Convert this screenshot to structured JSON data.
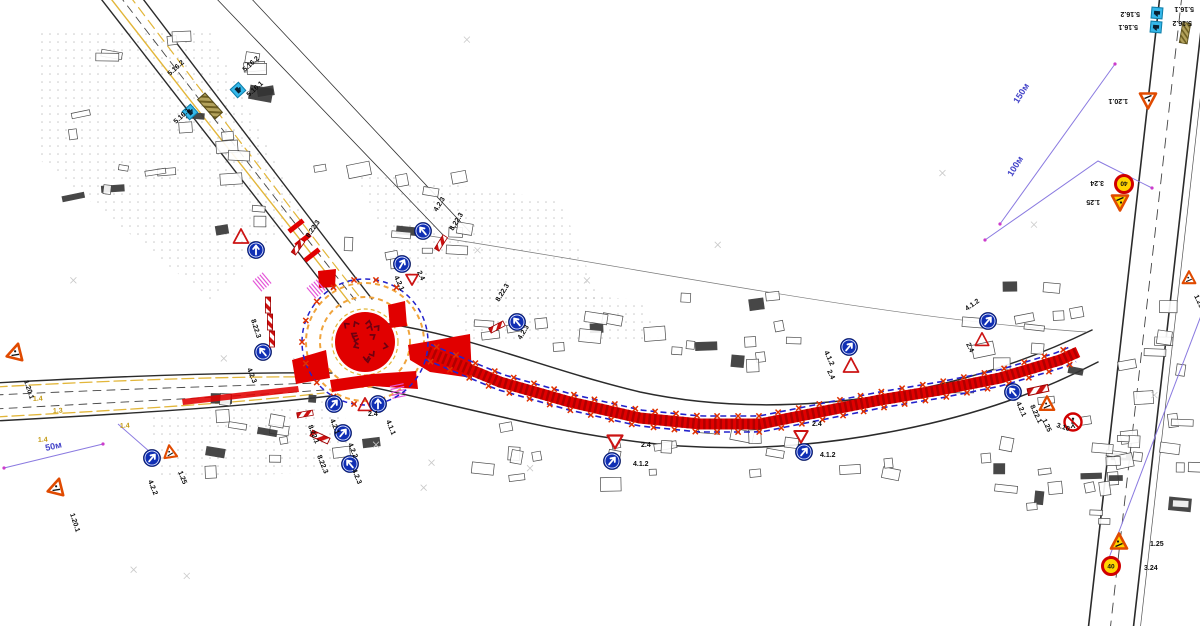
{
  "drawing": {
    "kind": "temporary-traffic-management-plan",
    "palette": {
      "work_zone_red": "#e10000",
      "work_zone_hatch": "#b00000",
      "barrier_blue": "#2323cc",
      "sign_blue": "#102fb4",
      "bus_cyan": "#35b8ea",
      "temp_yellow": "#ffd400",
      "warn_border": "#e04a00",
      "give_way_red": "#cc1414",
      "dim_purple": "#8a7ae0",
      "dim_text_blue": "#4343c8",
      "magenta": "#e457d8",
      "road_marking_yellow": "#e2b63a",
      "shelter_olive": "#8a7a30"
    },
    "signs": [
      {
        "type": "warn",
        "x": 16,
        "y": 352,
        "rot": 14
      },
      {
        "type": "warn",
        "x": 57,
        "y": 487,
        "rot": 14
      },
      {
        "type": "blue-circle",
        "x": 152,
        "y": 458,
        "arot": 40
      },
      {
        "type": "warn",
        "x": 170,
        "y": 452,
        "rot": -8,
        "scale": 0.8
      },
      {
        "type": "bus",
        "x": 190,
        "y": 112,
        "rot": 48
      },
      {
        "type": "bus",
        "x": 238,
        "y": 90,
        "rot": 48
      },
      {
        "type": "shelter",
        "x": 210,
        "y": 106,
        "rot": 48
      },
      {
        "type": "warn-line",
        "x": 241,
        "y": 237
      },
      {
        "type": "blue-circle",
        "x": 256,
        "y": 250,
        "arot": 0
      },
      {
        "type": "beacon",
        "x": 298,
        "y": 247,
        "rot": -55
      },
      {
        "type": "blue-circle",
        "x": 263,
        "y": 352,
        "arot": -40
      },
      {
        "type": "beacon",
        "x": 268,
        "y": 305,
        "rot": 90
      },
      {
        "type": "beacon",
        "x": 270,
        "y": 322,
        "rot": 90
      },
      {
        "type": "beacon",
        "x": 272,
        "y": 339,
        "rot": 90
      },
      {
        "type": "blue-circle",
        "x": 402,
        "y": 264,
        "arot": 30
      },
      {
        "type": "give-way",
        "x": 412,
        "y": 279,
        "scale": 0.8
      },
      {
        "type": "blue-circle",
        "x": 423,
        "y": 231,
        "arot": -40
      },
      {
        "type": "beacon",
        "x": 441,
        "y": 243,
        "rot": -58
      },
      {
        "type": "blue-circle",
        "x": 517,
        "y": 322,
        "arot": -40
      },
      {
        "type": "beacon",
        "x": 497,
        "y": 327,
        "rot": -28
      },
      {
        "type": "give-way",
        "x": 615,
        "y": 441
      },
      {
        "type": "blue-circle",
        "x": 612,
        "y": 461,
        "arot": 40
      },
      {
        "type": "give-way",
        "x": 801,
        "y": 436,
        "scale": 0.9
      },
      {
        "type": "blue-circle",
        "x": 804,
        "y": 452,
        "arot": 40
      },
      {
        "type": "blue-circle",
        "x": 849,
        "y": 347,
        "arot": 40
      },
      {
        "type": "warn-line",
        "x": 851,
        "y": 366
      },
      {
        "type": "blue-circle",
        "x": 988,
        "y": 321,
        "arot": 40
      },
      {
        "type": "warn-line",
        "x": 982,
        "y": 340,
        "scale": 0.9
      },
      {
        "type": "blue-circle",
        "x": 1013,
        "y": 392,
        "arot": -40
      },
      {
        "type": "beacon",
        "x": 1038,
        "y": 390,
        "rot": -12,
        "scale": 1.3
      },
      {
        "type": "warn",
        "x": 1047,
        "y": 404,
        "scale": 0.9
      },
      {
        "type": "no-ped",
        "x": 1073,
        "y": 422
      },
      {
        "type": "warn-temp",
        "x": 1119,
        "y": 542
      },
      {
        "type": "speed40",
        "x": 1111,
        "y": 566
      },
      {
        "type": "warn-temp",
        "x": 1120,
        "y": 202,
        "rot": 180
      },
      {
        "type": "speed40",
        "x": 1124,
        "y": 184,
        "rot": 180
      },
      {
        "type": "warn",
        "x": 1148,
        "y": 100,
        "rot": 180
      },
      {
        "type": "bus",
        "x": 1157,
        "y": 13,
        "rot": 185
      },
      {
        "type": "bus",
        "x": 1156,
        "y": 27,
        "rot": 185
      },
      {
        "type": "shelter",
        "x": 1185,
        "y": 33,
        "rot": 100,
        "scale": 0.8
      },
      {
        "type": "warn",
        "x": 1189,
        "y": 278,
        "scale": 0.8
      },
      {
        "type": "beacon",
        "x": 305,
        "y": 414,
        "rot": -10
      },
      {
        "type": "beacon",
        "x": 320,
        "y": 437,
        "rot": 25,
        "scale": 1.2
      },
      {
        "type": "blue-circle",
        "x": 334,
        "y": 404,
        "arot": 40
      },
      {
        "type": "warn-line",
        "x": 365,
        "y": 405,
        "scale": 0.9
      },
      {
        "type": "blue-circle",
        "x": 378,
        "y": 404,
        "arot": 0
      },
      {
        "type": "blue-circle",
        "x": 343,
        "y": 433,
        "arot": 40
      },
      {
        "type": "blue-circle",
        "x": 350,
        "y": 464,
        "arot": -40
      }
    ],
    "sign_code_labels": [
      {
        "t": "1.20.1",
        "x": 24,
        "y": 381,
        "r": 72
      },
      {
        "t": "1.20.1",
        "x": 70,
        "y": 514,
        "r": 72
      },
      {
        "t": "4.2.2",
        "x": 148,
        "y": 481,
        "r": 68
      },
      {
        "t": "1.25",
        "x": 178,
        "y": 472,
        "r": 68
      },
      {
        "t": "5.16.2",
        "x": 170,
        "y": 76,
        "r": -42
      },
      {
        "t": "5.16.1",
        "x": 176,
        "y": 124,
        "r": -42
      },
      {
        "t": "5.16.2",
        "x": 245,
        "y": 72,
        "r": -42
      },
      {
        "t": "5.16.1",
        "x": 249,
        "y": 97,
        "r": -42
      },
      {
        "t": "8.22.3",
        "x": 251,
        "y": 320,
        "r": 72
      },
      {
        "t": "4.2.3",
        "x": 247,
        "y": 369,
        "r": 68
      },
      {
        "t": "8.22.3",
        "x": 309,
        "y": 238,
        "r": -55
      },
      {
        "t": "4.2.3",
        "x": 437,
        "y": 212,
        "r": -58
      },
      {
        "t": "8.22.3",
        "x": 453,
        "y": 231,
        "r": -58
      },
      {
        "t": "4.2.1",
        "x": 394,
        "y": 277,
        "r": 65
      },
      {
        "t": "2.4",
        "x": 417,
        "y": 272,
        "r": 65
      },
      {
        "t": "8.22.3",
        "x": 499,
        "y": 302,
        "r": -58
      },
      {
        "t": "4.2.3",
        "x": 521,
        "y": 340,
        "r": -58
      },
      {
        "t": "2.4",
        "x": 641,
        "y": 447,
        "r": 0
      },
      {
        "t": "4.1.2",
        "x": 633,
        "y": 466,
        "r": 0
      },
      {
        "t": "2.4",
        "x": 812,
        "y": 426,
        "r": 0
      },
      {
        "t": "4.1.2",
        "x": 820,
        "y": 457,
        "r": 0
      },
      {
        "t": "4.1.2",
        "x": 824,
        "y": 352,
        "r": 65
      },
      {
        "t": "2.4",
        "x": 827,
        "y": 371,
        "r": 65
      },
      {
        "t": "4.1.2",
        "x": 967,
        "y": 311,
        "r": -35
      },
      {
        "t": "2.4",
        "x": 966,
        "y": 344,
        "r": 65
      },
      {
        "t": "4.2.1",
        "x": 1016,
        "y": 403,
        "r": 65
      },
      {
        "t": "8.22.1",
        "x": 1030,
        "y": 406,
        "r": 65
      },
      {
        "t": "1.25",
        "x": 1042,
        "y": 420,
        "r": 65
      },
      {
        "t": "3.10",
        "x": 1056,
        "y": 427,
        "r": 18
      },
      {
        "t": "1.25",
        "x": 1150,
        "y": 546,
        "r": 0
      },
      {
        "t": "3.24",
        "x": 1144,
        "y": 570,
        "r": 0
      },
      {
        "t": "3.24",
        "x": 1104,
        "y": 181,
        "r": 180
      },
      {
        "t": "1.25",
        "x": 1100,
        "y": 200,
        "r": 180
      },
      {
        "t": "1.20.1",
        "x": 1128,
        "y": 99,
        "r": 180
      },
      {
        "t": "5.16.2",
        "x": 1140,
        "y": 12,
        "r": 180
      },
      {
        "t": "5.16.1",
        "x": 1138,
        "y": 25,
        "r": 180
      },
      {
        "t": "5.16.1",
        "x": 1194,
        "y": 7,
        "r": 180
      },
      {
        "t": "5.16.2",
        "x": 1192,
        "y": 21,
        "r": 180
      },
      {
        "t": "1.25",
        "x": 1194,
        "y": 296,
        "r": 65
      },
      {
        "t": "8.22.1",
        "x": 308,
        "y": 426,
        "r": 68
      },
      {
        "t": "4.2.1",
        "x": 330,
        "y": 420,
        "r": 68
      },
      {
        "t": "4.2.2",
        "x": 348,
        "y": 444,
        "r": 68
      },
      {
        "t": "8.22.3",
        "x": 317,
        "y": 456,
        "r": 68
      },
      {
        "t": "4.2.3",
        "x": 352,
        "y": 470,
        "r": 68
      },
      {
        "t": "2.4",
        "x": 368,
        "y": 416,
        "r": 0
      },
      {
        "t": "4.1.1",
        "x": 386,
        "y": 421,
        "r": 68
      }
    ],
    "road_marking_labels": [
      {
        "t": "1.4",
        "x": 33,
        "y": 401,
        "r": -3
      },
      {
        "t": "1.3",
        "x": 53,
        "y": 413,
        "r": -3
      },
      {
        "t": "1.4",
        "x": 38,
        "y": 442,
        "r": -3
      },
      {
        "t": "1.4",
        "x": 120,
        "y": 428,
        "r": -3
      }
    ],
    "dimensions": [
      {
        "label": "150м",
        "pts": [
          [
            1115,
            64
          ],
          [
            1000,
            224
          ]
        ],
        "tx": 1018,
        "ty": 104,
        "tr": -58
      },
      {
        "label": "100м",
        "pts": [
          [
            1152,
            188
          ],
          [
            1098,
            161
          ],
          [
            985,
            240
          ]
        ],
        "tx": 1012,
        "ty": 177,
        "tr": -58
      },
      {
        "label": "50м",
        "pts": [
          [
            4,
            468
          ],
          [
            103,
            444
          ]
        ],
        "tx": 46,
        "ty": 451,
        "tr": -13
      }
    ],
    "leader_lines": [
      [
        [
          118,
          424
        ],
        [
          150,
          452
        ]
      ],
      [
        [
          1104,
          571
        ],
        [
          1240,
          213
        ]
      ]
    ],
    "speed_limit_value": "40"
  }
}
